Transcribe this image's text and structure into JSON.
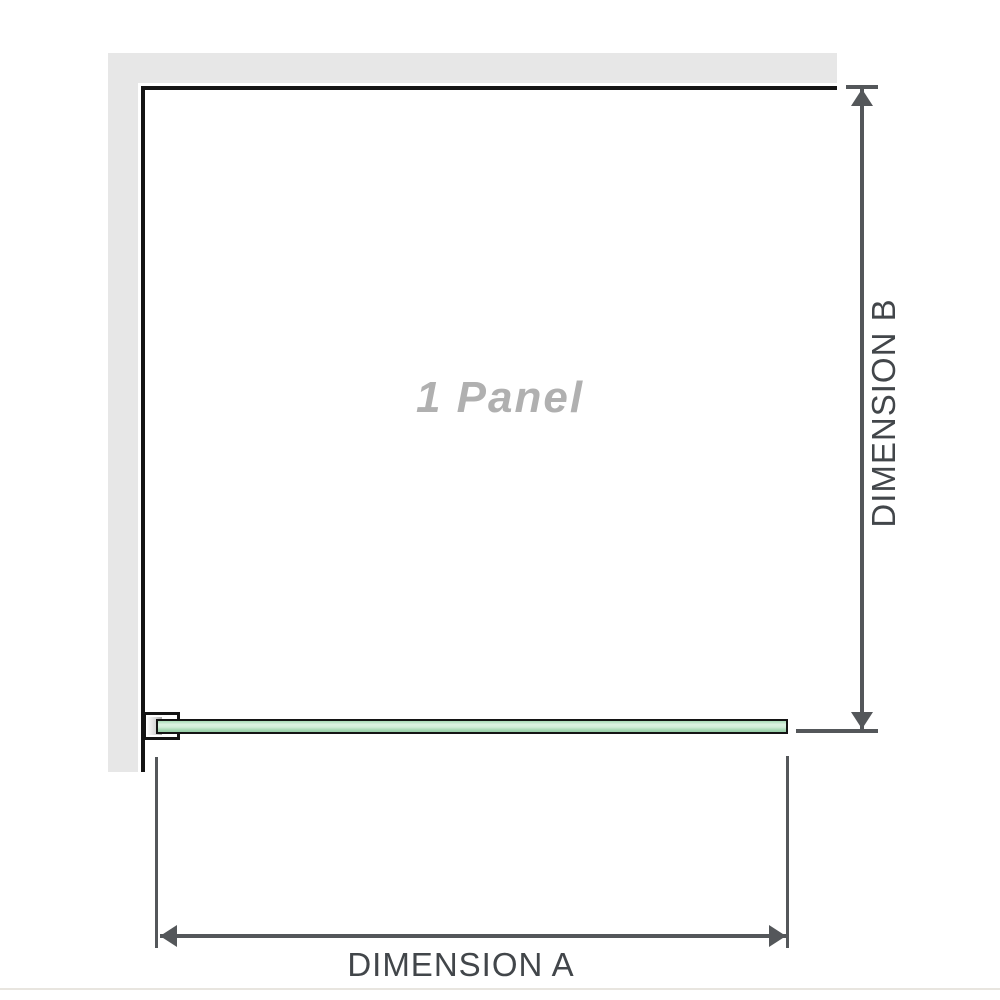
{
  "diagram": {
    "panel_label": "1 Panel",
    "dimension_a": {
      "label": "DIMENSION A"
    },
    "dimension_b": {
      "label": "DIMENSION B"
    },
    "colors": {
      "wall": "#e7e7e7",
      "outline": "#141414",
      "dimension_lines": "#54575a",
      "dimension_text": "#42464a",
      "glass_highlight": "#ddf2e2",
      "glass_green": "#a3d6b1",
      "panel_label_text": "#b0b0b0",
      "bracket_metal": "#a8a8a8",
      "footer_divider": "#e8e5df"
    }
  }
}
